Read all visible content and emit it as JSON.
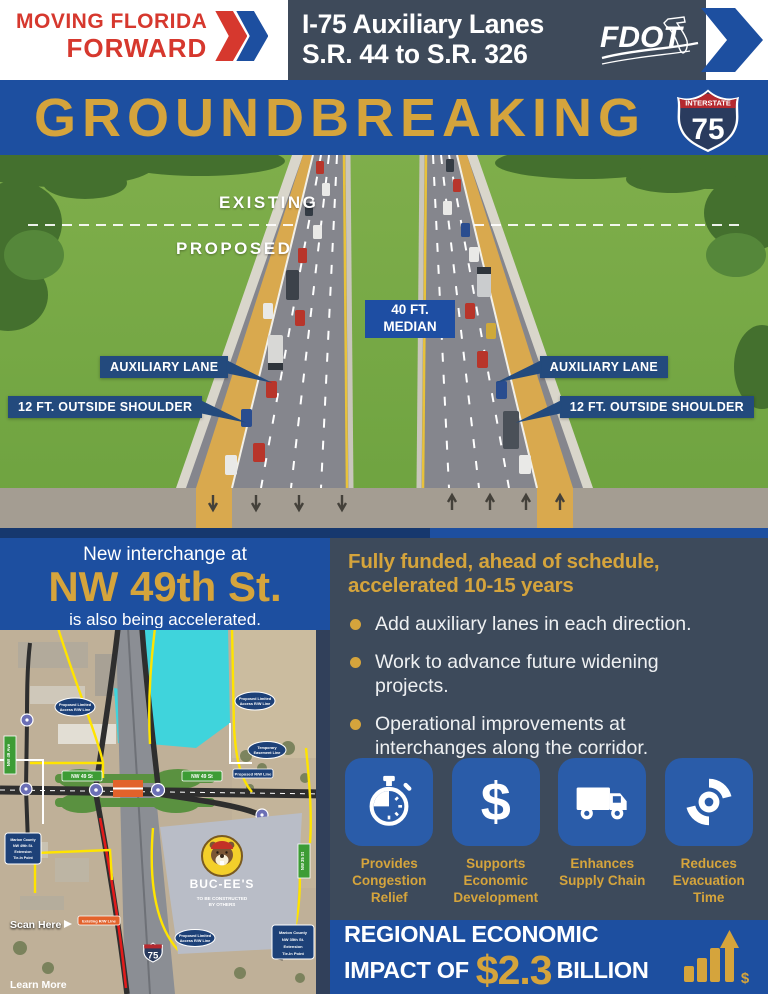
{
  "colors": {
    "dark_slate": "#3e4a5a",
    "royal_blue": "#1d4fa0",
    "gold": "#d5a43c",
    "red": "#d6382e",
    "tile_blue": "#2a5ca9",
    "callout_navy": "#234a7d"
  },
  "header": {
    "brand_line1": "MOVING FLORIDA",
    "brand_line2": "FORWARD",
    "title_line1": "I-75 Auxiliary Lanes",
    "title_line2": "S.R. 44 to S.R. 326",
    "fdot_logo": "FDOT"
  },
  "banner": {
    "title": "GROUNDBREAKING",
    "shield_top": "INTERSTATE",
    "shield_number": "75"
  },
  "scene": {
    "existing": "EXISTING",
    "proposed": "PROPOSED",
    "median": "40 FT. MEDIAN",
    "aux_left": "AUXILIARY LANE",
    "aux_right": "AUXILIARY LANE",
    "shoulder_left": "12 FT. OUTSIDE SHOULDER",
    "shoulder_right": "12 FT. OUTSIDE SHOULDER"
  },
  "interchange": {
    "line1": "New interchange at",
    "street": "NW 49th St.",
    "line2": "is also being accelerated."
  },
  "funding": {
    "heading": "Fully funded, ahead of schedule, accelerated 10-15 years",
    "bullets": [
      "Add auxiliary lanes in each direction.",
      "Work to advance future widening projects.",
      "Operational improvements at interchanges along the corridor."
    ]
  },
  "benefits": [
    {
      "icon": "stopwatch-icon",
      "label": "Provides Congestion Relief"
    },
    {
      "icon": "dollar-icon",
      "label": "Supports Economic Development"
    },
    {
      "icon": "truck-icon",
      "label": "Enhances Supply Chain"
    },
    {
      "icon": "hurricane-icon",
      "label": "Reduces Evacuation Time"
    }
  ],
  "impact": {
    "line1": "REGIONAL ECONOMIC",
    "line2_prefix": "IMPACT OF",
    "amount": "$2.3",
    "suffix": "BILLION"
  },
  "map": {
    "badges": {
      "proposed_limited_left": [
        "Proposed Limited",
        "Access R/W Line"
      ],
      "proposed_limited_right": [
        "Proposed Limited",
        "Access R/W Line"
      ],
      "temporary_easement": [
        "Temporary",
        "Easement Line"
      ],
      "proposed_rw": "Proposed R/W Line",
      "existing_rw": "Existing R/W Line",
      "proposed_limited_bottom": [
        "Proposed Limited",
        "Access R/W Line"
      ],
      "marion_49": [
        "Marion County",
        "NW 49th St.",
        "Extension",
        "Tie-In Point"
      ],
      "marion_35": [
        "Marion County",
        "NW 35th St.",
        "Extension",
        "Tie-In Point"
      ],
      "nw49_ave": "NW 49 Ave",
      "nw49_st_left": "NW 49 St",
      "nw49_st_right": "NW 49 St",
      "nw35_st": "NW 35 St"
    },
    "bucees": {
      "name": "BUC-EE'S",
      "note_line1": "TO BE CONSTRUCTED",
      "note_line2": "BY OTHERS"
    },
    "i75_shield": "75",
    "scan_here": "Scan Here",
    "learn_more": "Learn More"
  }
}
